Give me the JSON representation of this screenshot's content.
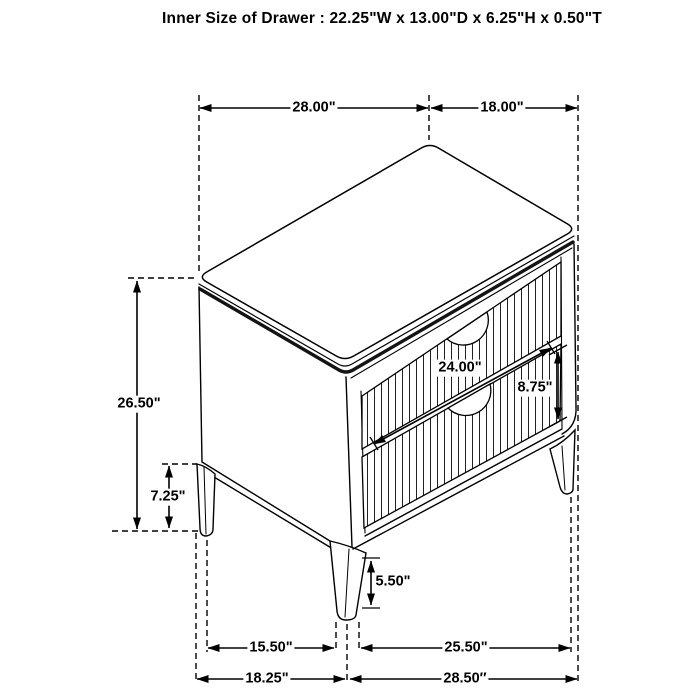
{
  "title": "Inner Size of Drawer : 22.25\"W x 13.00\"D x 6.25\"H x 0.50\"T",
  "drawing": {
    "subject": "2-drawer nightstand, isometric line drawing with dimensions",
    "line_color": "#000000",
    "background_color": "#ffffff"
  },
  "labels": {
    "top_width": "28.00\"",
    "top_depth": "18.00\"",
    "overall_height": "26.50\"",
    "base_height": "7.25\"",
    "drawer_width": "24.00\"",
    "drawer_height": "8.75\"",
    "leg_height": "5.50\"",
    "leg_span_side": "15.50\"",
    "leg_span_front": "25.50\"",
    "overall_depth": "18.25\"",
    "overall_width": "28.50″"
  }
}
